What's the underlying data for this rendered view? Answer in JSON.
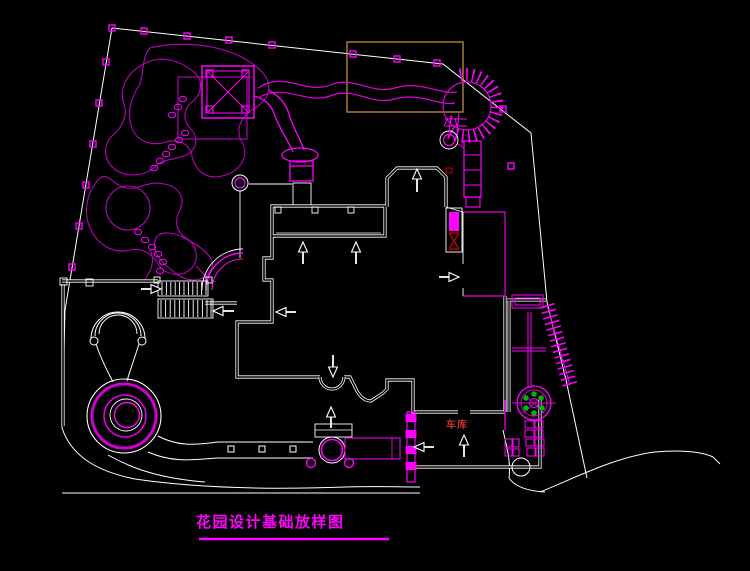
{
  "canvas": {
    "width": 750,
    "height": 571,
    "background": "#000000"
  },
  "titleBlock": {
    "title": "花园设计基础放样图"
  },
  "annotations": {
    "garage": "车库"
  },
  "palette": {
    "primaryLine": "#FF00FF",
    "secondaryLine": "#BB00BB",
    "outlineWhite": "#FFFFFF",
    "highlightBox": "#B5823C",
    "labelRed": "#C03030",
    "plantGreen": "#00B400"
  }
}
